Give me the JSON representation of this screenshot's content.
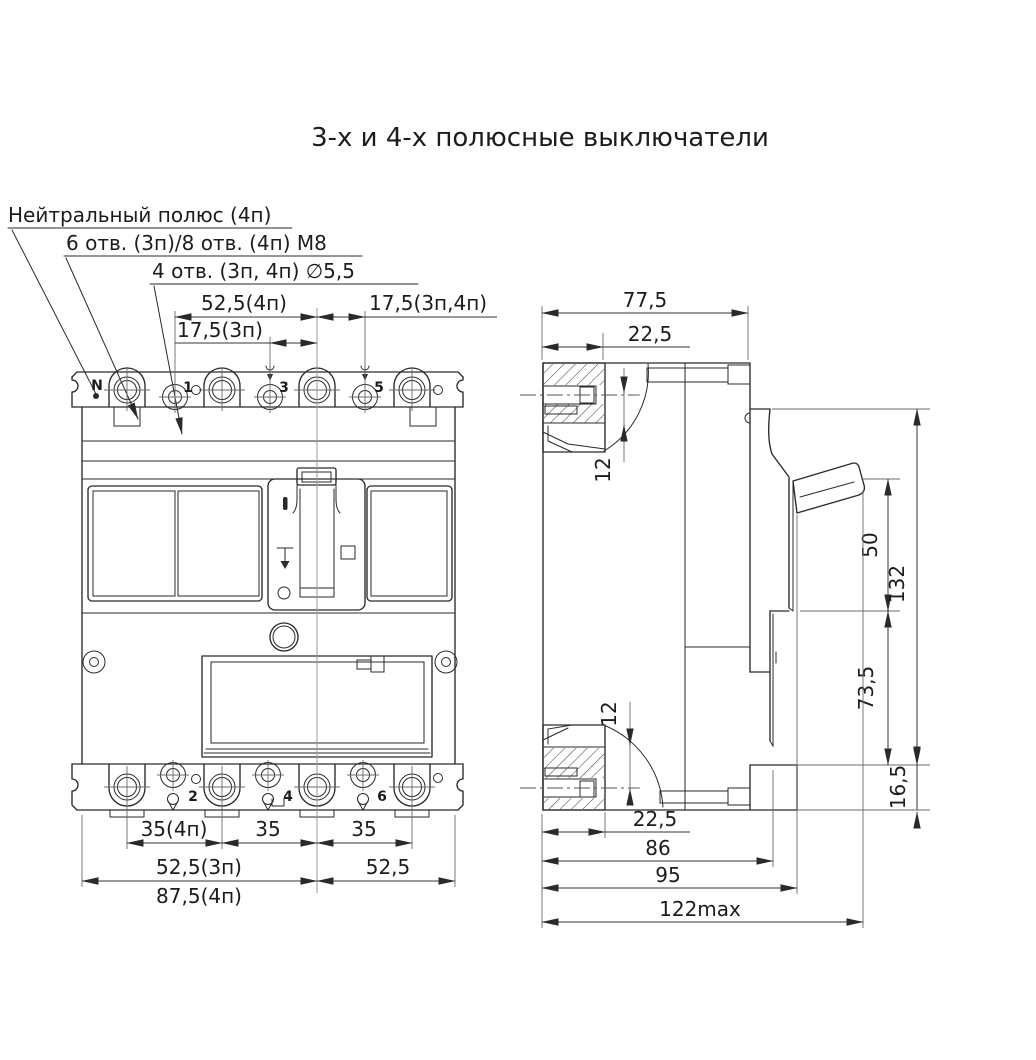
{
  "page": {
    "title": "3-х и 4-х полюсные выключатели",
    "background": "#ffffff"
  },
  "colors": {
    "line": "#2a2a2a",
    "dimension": "#353535",
    "centerline": "#9a9a9a"
  },
  "callouts": {
    "neutral_pole": "Нейтральный полюс (4п)",
    "holes_m8": "6 отв. (3п)/8 отв. (4п) М8",
    "holes_d55": "4 отв. (3п, 4п) ∅5,5"
  },
  "front_view": {
    "pole_labels_top": [
      "N",
      "1",
      "3",
      "5"
    ],
    "pole_labels_bottom": [
      "2",
      "4",
      "6"
    ],
    "dims": {
      "top_52_5_4p": "52,5(4п)",
      "top_17_5_3p4p": "17,5(3п,4п)",
      "top_17_5_3p": "17,5(3п)",
      "bottom_35_4p": "35(4п)",
      "bottom_35_a": "35",
      "bottom_35_b": "35",
      "bottom_52_5_3p": "52,5(3п)",
      "bottom_87_5_4p": "87,5(4п)",
      "bottom_52_5": "52,5"
    }
  },
  "side_view": {
    "dims": {
      "top_77_5": "77,5",
      "top_22_5": "22,5",
      "upper_12": "12",
      "lower_12": "12",
      "right_50": "50",
      "right_132": "132",
      "right_73_5": "73,5",
      "right_16_5": "16,5",
      "bottom_22_5": "22,5",
      "bottom_86": "86",
      "bottom_95": "95",
      "bottom_122max": "122max"
    }
  }
}
